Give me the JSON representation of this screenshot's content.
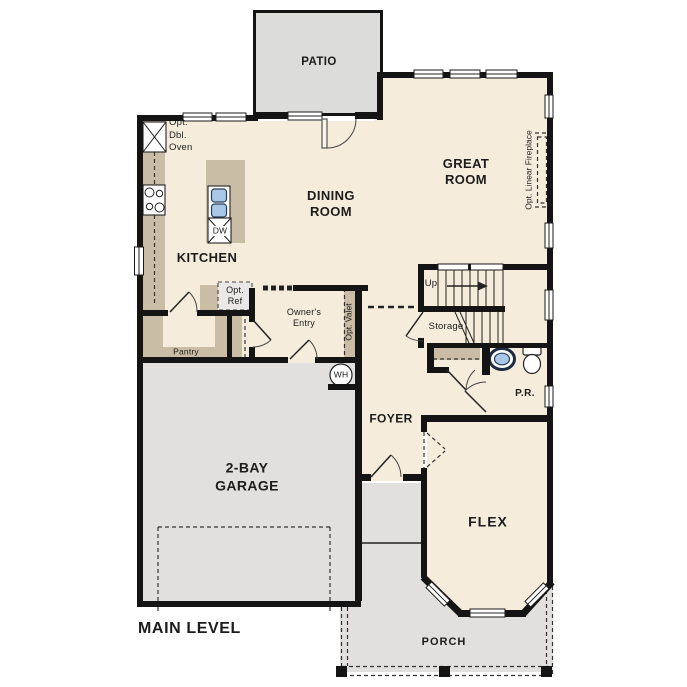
{
  "plan": {
    "title": "MAIN LEVEL",
    "rooms": {
      "patio": "PATIO",
      "great_room": "GREAT ROOM",
      "dining_room": "DINING ROOM",
      "kitchen": "KITCHEN",
      "garage": "2-BAY GARAGE",
      "foyer": "FOYER",
      "flex": "FLEX",
      "porch": "PORCH",
      "powder_room": "P.R.",
      "pantry": "Pantry",
      "storage": "Storage",
      "owners_entry": "Owner's Entry"
    },
    "annotations": {
      "up": "Up",
      "opt_dbl_oven": "Opt. Dbl. Oven",
      "opt_ref": "Opt. Ref",
      "opt_valet": "Opt. Valet",
      "opt_linear_fireplace": "Opt. Linear Fireplace",
      "dishwasher": "DW",
      "water_heater": "WH"
    }
  },
  "colors": {
    "floor": "#f5ecdb",
    "patio": "#dcdcdb",
    "outdoor": "#e1e0de",
    "cabinet": "#c9bda6",
    "wall": "#141414",
    "ink": "#1c1c1c",
    "sink_blue": "#a9c7e6",
    "optional_box": "#e9e8e6"
  }
}
